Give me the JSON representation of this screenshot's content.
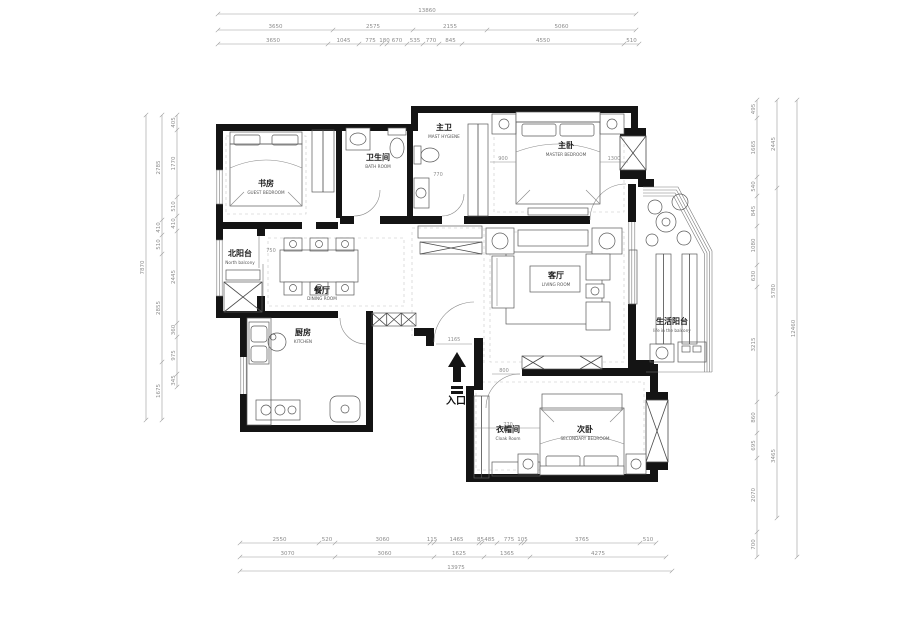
{
  "rooms": {
    "guest_bedroom": {
      "zh": "书房",
      "en": "GUEST BEDROOM"
    },
    "bath": {
      "zh": "卫生间",
      "en": "BATH ROOM"
    },
    "master_bath": {
      "zh": "主卫",
      "en": "MAST HYGIENE"
    },
    "master_bedroom": {
      "zh": "主卧",
      "en": "MASTER BEDROOM"
    },
    "north_balcony": {
      "zh": "北阳台",
      "en": "North balcony"
    },
    "dining": {
      "zh": "餐厅",
      "en": "DINING ROOM"
    },
    "kitchen": {
      "zh": "厨房",
      "en": "KITCHEN"
    },
    "living": {
      "zh": "客厅",
      "en": "LIVING ROOM"
    },
    "life_balcony": {
      "zh": "生活阳台",
      "en": "life in the balcony"
    },
    "cloak": {
      "zh": "衣帽间",
      "en": "Cloak Room"
    },
    "secondary_bedroom": {
      "zh": "次卧",
      "en": "SECONDARY BEDROOM"
    }
  },
  "entry": {
    "label": "入口",
    "dim": "1165"
  },
  "interior_dims": {
    "master_left": "900",
    "master_right": "1300",
    "master_bath": "770",
    "dining": "750",
    "living": "800",
    "secondary": "770"
  },
  "colors": {
    "wall": "#141414",
    "dim_line": "#9a9a9a",
    "background": "#ffffff"
  },
  "dimensions": {
    "chains": [
      {
        "id": "top-total",
        "orient": "h",
        "pos": 14,
        "stops": [
          218,
          636
        ],
        "values": [
          "13860"
        ]
      },
      {
        "id": "top-major",
        "orient": "h",
        "pos": 30,
        "stops": [
          218,
          333,
          413,
          487,
          636
        ],
        "values": [
          "3650",
          "2575",
          "2155",
          "5060"
        ]
      },
      {
        "id": "top-minor",
        "orient": "h",
        "pos": 44,
        "stops": [
          218,
          328,
          359,
          382,
          387,
          407,
          423,
          439,
          462,
          624,
          639
        ],
        "values": [
          "3650",
          "1045",
          "775",
          "180",
          "670",
          "535",
          "770",
          "845",
          "4550",
          "510"
        ]
      },
      {
        "id": "left-total",
        "orient": "v",
        "pos": 146,
        "stops": [
          115,
          420
        ],
        "values": [
          "7870"
        ]
      },
      {
        "id": "left-major",
        "orient": "v",
        "pos": 162,
        "stops": [
          115,
          220,
          235,
          254,
          362,
          420
        ],
        "values": [
          "2785",
          "410",
          "510",
          "2855",
          "1675"
        ]
      },
      {
        "id": "left-minor",
        "orient": "v",
        "pos": 177,
        "stops": [
          115,
          130,
          197,
          216,
          231,
          323,
          337,
          374,
          387
        ],
        "values": [
          "405",
          "1770",
          "510",
          "410",
          "2445",
          "360",
          "975",
          "345"
        ]
      },
      {
        "id": "right-minor",
        "orient": "v",
        "pos": 757,
        "stops": [
          100,
          118,
          177,
          196,
          226,
          265,
          287,
          402,
          433,
          458,
          532,
          557
        ],
        "values": [
          "495",
          "1665",
          "540",
          "845",
          "1080",
          "630",
          "3215",
          "860",
          "695",
          "2070",
          "700"
        ]
      },
      {
        "id": "right-major",
        "orient": "v",
        "pos": 777,
        "stops": [
          100,
          188,
          394,
          518
        ],
        "values": [
          "2445",
          "5780",
          "3465"
        ]
      },
      {
        "id": "right-total",
        "orient": "v",
        "pos": 797,
        "stops": [
          100,
          557
        ],
        "values": [
          "12460"
        ]
      },
      {
        "id": "bottom-minor",
        "orient": "h",
        "pos": 543,
        "stops": [
          240,
          319,
          335,
          430,
          434,
          479,
          482,
          497,
          521,
          524,
          640,
          656
        ],
        "values": [
          "2550",
          "520",
          "3060",
          "115",
          "1465",
          "85",
          "485",
          "775",
          "105",
          "3765",
          "510"
        ]
      },
      {
        "id": "bottom-major",
        "orient": "h",
        "pos": 557,
        "stops": [
          240,
          335,
          434,
          484,
          530,
          666
        ],
        "values": [
          "3070",
          "3060",
          "1625",
          "1365",
          "4275"
        ]
      },
      {
        "id": "bottom-total",
        "orient": "h",
        "pos": 571,
        "stops": [
          240,
          672
        ],
        "values": [
          "13975"
        ]
      }
    ]
  }
}
